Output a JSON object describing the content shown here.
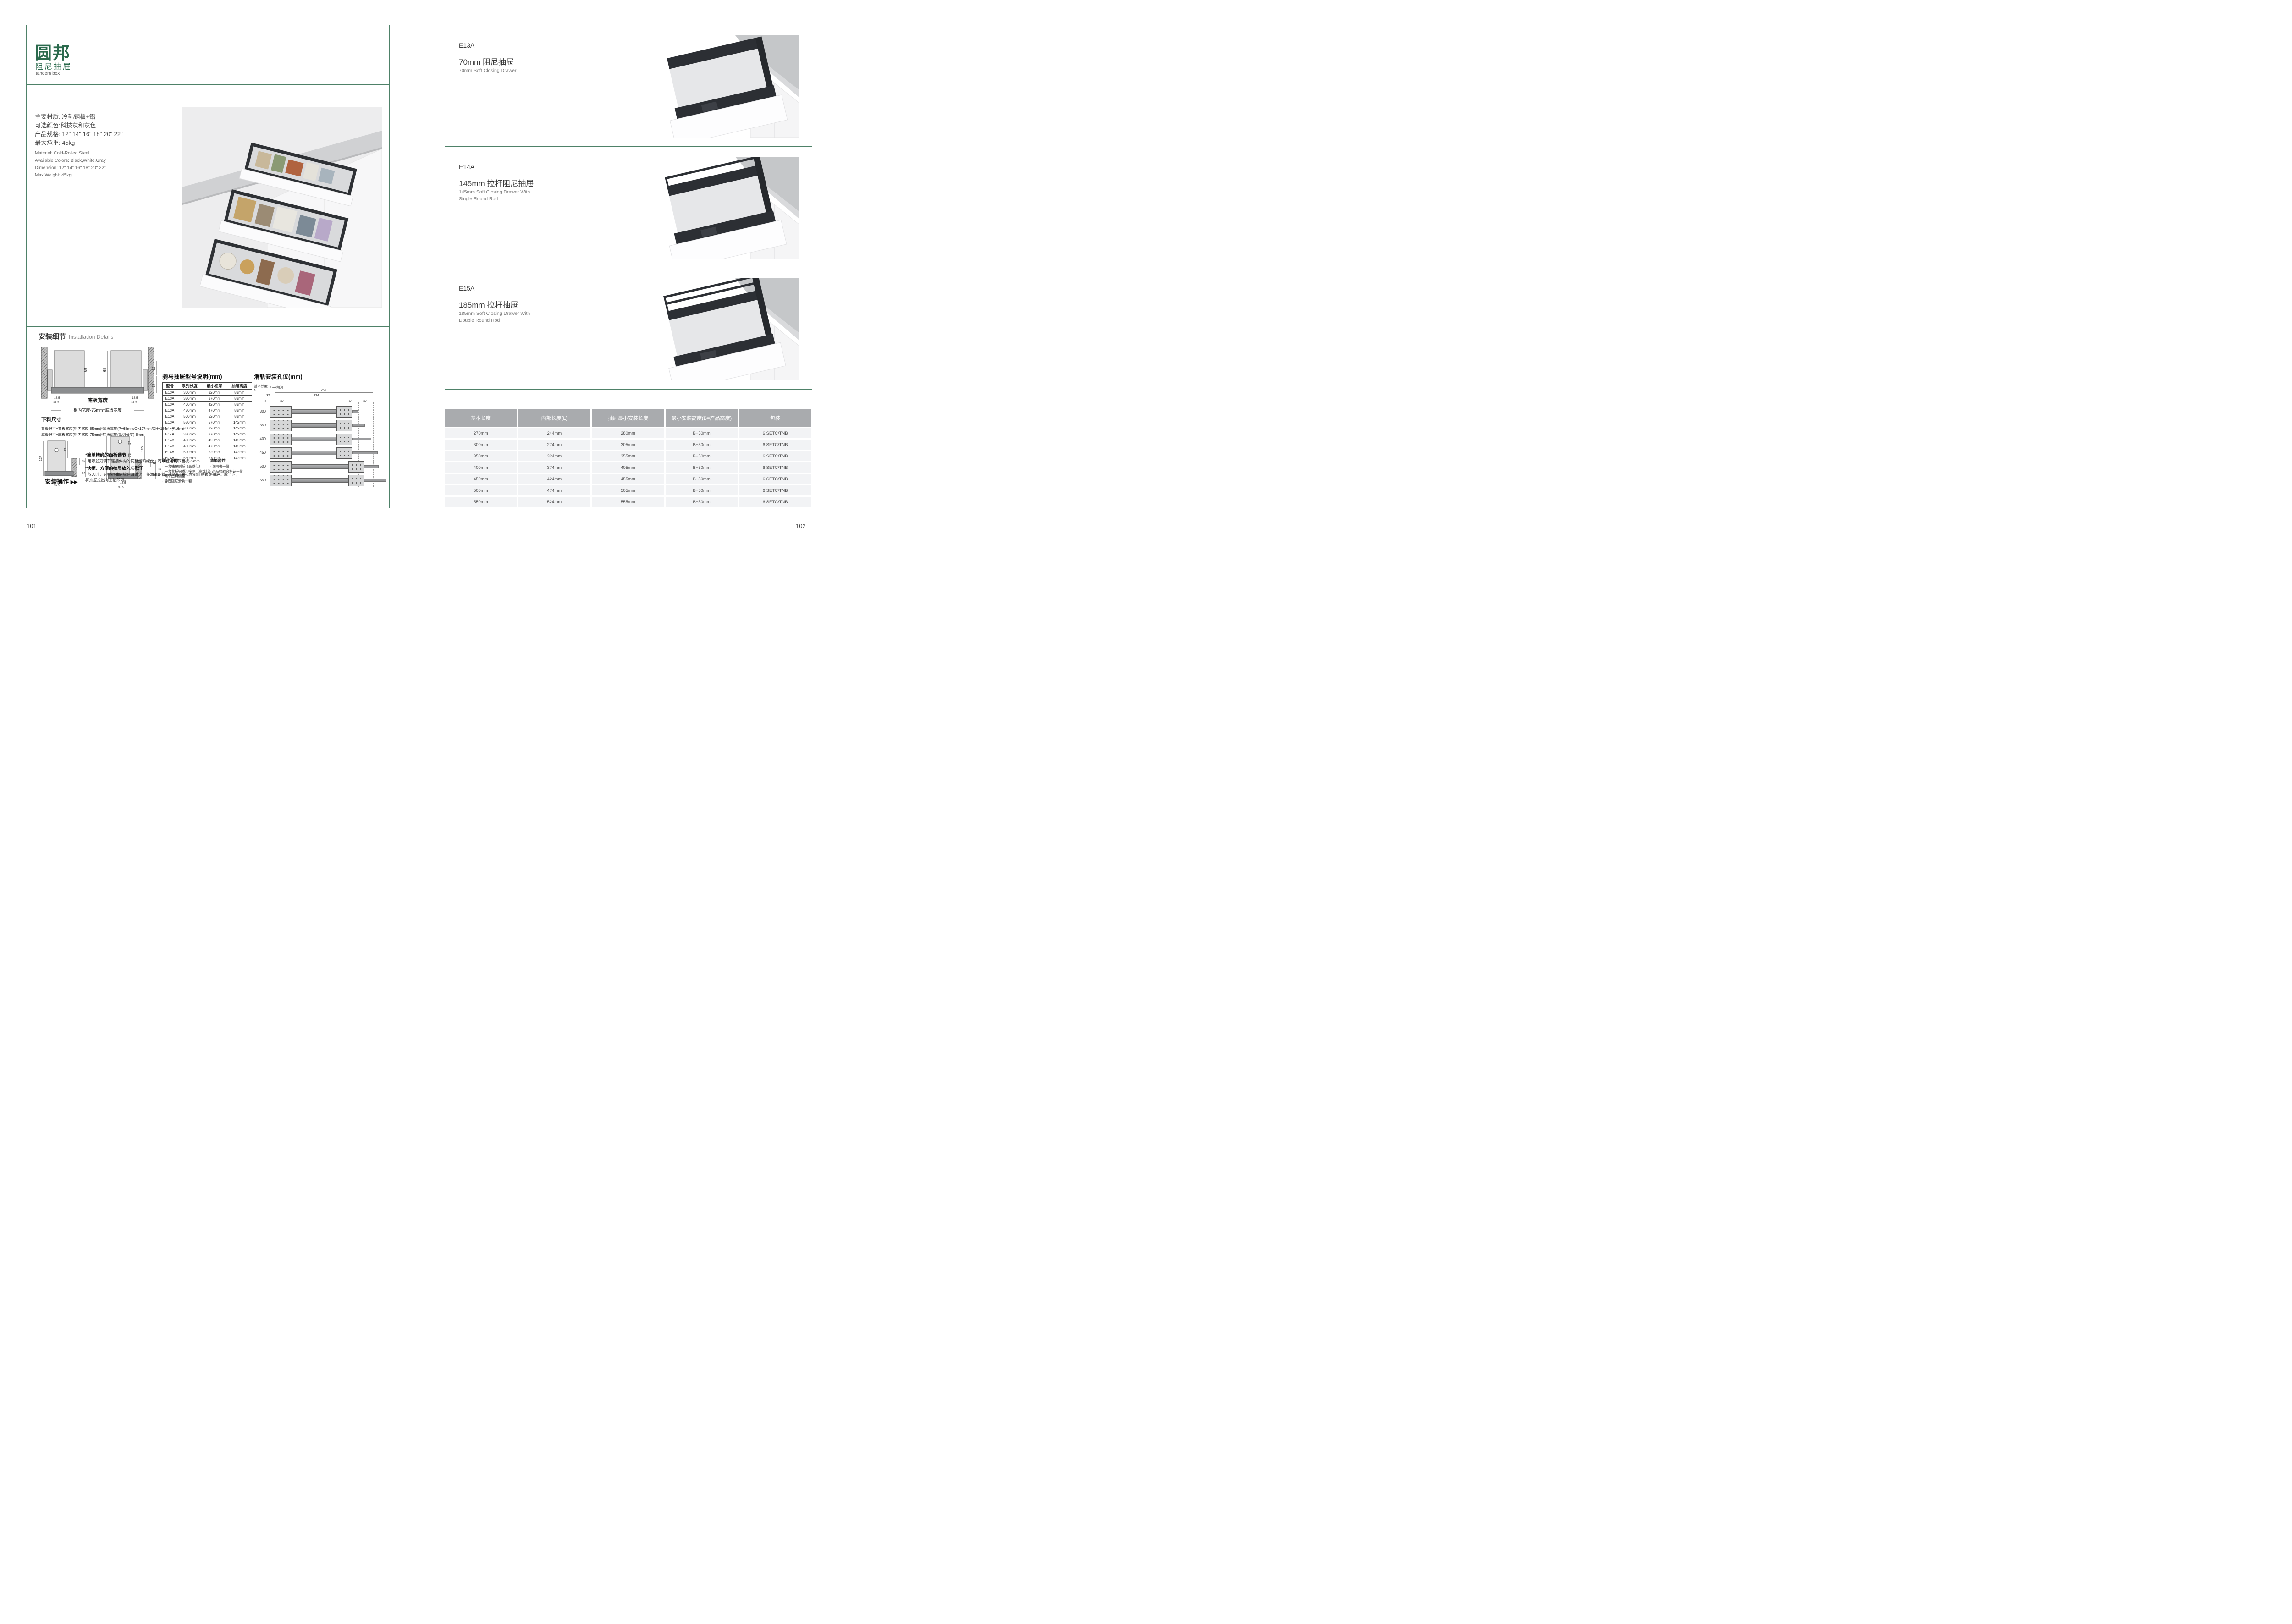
{
  "page_left": {
    "page_number": "101",
    "brand": {
      "logo": "圆邦",
      "subtitle_zh": "阻尼抽屉",
      "subtitle_en": "tandem box"
    },
    "specs_zh": [
      "主要材质: 冷轧钢板+铝",
      "可选颜色:科技灰和灰色",
      "产品规格: 12\" 14\" 16\" 18\" 20\" 22\"",
      "最大承重: 45kg"
    ],
    "specs_en": [
      "Material: Cold-Rolled Steel",
      "Available Colors: Black,White,Gray",
      "Dimension: 12\" 14\" 16\" 18\" 20\" 22\"",
      "Max Weight: 45kg"
    ],
    "install": {
      "title_zh": "安装细节",
      "title_en": "Installation Details",
      "cross_section": {
        "d68a": "68",
        "d68b": "68",
        "d46": "46",
        "d32": "32",
        "d54": "54",
        "d165a": "16.5",
        "d375a": "37.5",
        "d165b": "16.5",
        "d375b": "37.5",
        "bottom_label": "底板宽度",
        "formula_label": "柜内宽度-75mm=底板宽度"
      },
      "cutting": {
        "title": "下料尺寸",
        "line1": "背板尺寸=背板宽度(柜内宽度-85mm)*背板高度(P=68mm/G=127mm/GH=180mm)*16mm",
        "line2": "底板尺寸=底板宽度(柜内宽度-75mm)*底板深度(系列长度)-8mm"
      },
      "side_low": {
        "d127": "127",
        "d77": "77",
        "d32": "32",
        "d86": "86",
        "d54": "54",
        "d165": "16.5",
        "d375": "37.5"
      },
      "side_high": {
        "d180": "180",
        "d57": "57",
        "d73": "73",
        "d130": "130",
        "d32": "32",
        "d86": "86",
        "d54": "54",
        "d165": "16.5",
        "d375": "37.5"
      },
      "operation": {
        "label": "安装操作",
        "arrows": "▶▶",
        "note1_title": "*简单精确的面板调节",
        "note1_body": "· 用螺丝刀调节连接件内的调整塑料螺丝，可以左右调节面板±3mm",
        "note2_title": "*快捷、方便的抽屉放入与取下",
        "note2_body": "· 放入时，只需把抽屉放在滑道上，将滑道的缓冲挡块向后拉就能自动锁定抽屉。取下时，将抽屉拉出向上抬即可。"
      }
    },
    "model_table": {
      "title": "骑马抽屉型号说明(mm)",
      "headers": [
        "型号",
        "系列长度",
        "最小柜深",
        "抽屉高度"
      ],
      "rows": [
        {
          "model": "E13A",
          "length": "300mm",
          "depth": "320mm",
          "height": "83mm"
        },
        {
          "model": "E13A",
          "length": "350mm",
          "depth": "370mm",
          "height": "83mm"
        },
        {
          "model": "E13A",
          "length": "400mm",
          "depth": "420mm",
          "height": "83mm"
        },
        {
          "model": "E13A",
          "length": "450mm",
          "depth": "470mm",
          "height": "83mm"
        },
        {
          "model": "E13A",
          "length": "500mm",
          "depth": "520mm",
          "height": "83mm"
        },
        {
          "model": "E13A",
          "length": "550mm",
          "depth": "570mm",
          "height": "142mm"
        },
        {
          "model": "E14A",
          "length": "300mm",
          "depth": "320mm",
          "height": "142mm"
        },
        {
          "model": "E14A",
          "length": "350mm",
          "depth": "370mm",
          "height": "142mm"
        },
        {
          "model": "E14A",
          "length": "400mm",
          "depth": "420mm",
          "height": "142mm"
        },
        {
          "model": "E14A",
          "length": "450mm",
          "depth": "470mm",
          "height": "142mm"
        },
        {
          "model": "E14A",
          "length": "500mm",
          "depth": "520mm",
          "height": "142mm"
        },
        {
          "model": "E14A",
          "length": "550mm",
          "depth": "570mm",
          "height": "142mm"
        }
      ]
    },
    "components": {
      "title": "组件说明",
      "items": [
        "· 一套抽屉侧板（高或低）",
        "· 一套背板钢质连接件（高或低）",
        "· 两个塑料侧盖",
        "· 静音阻尼滑轨一套"
      ]
    },
    "accessories": {
      "title": "装箱附件",
      "items": [
        "· 说明书一份",
        "· 产品检验合格证一份"
      ]
    },
    "rail_diagram": {
      "title": "滑轨安装孔位(mm)",
      "axis_label": "基本长度",
      "axis_label2": "N L",
      "front_edge_label": "柜子前沿",
      "d37": "37",
      "d9": "9",
      "d32a": "32",
      "d224": "224",
      "d256": "256",
      "d32b": "32",
      "d32c": "32",
      "lengths": [
        "300",
        "350",
        "400",
        "450",
        "500",
        "550"
      ]
    }
  },
  "page_right": {
    "page_number": "102",
    "sections": [
      {
        "model": "E13A",
        "title_zh": "70mm 阻尼抽屉",
        "title_en1": "70mm Soft Closing Drawer",
        "title_en2": ""
      },
      {
        "model": "E14A",
        "title_zh": "145mm 拉杆阻尼抽屉",
        "title_en1": "145mm Soft Closing Drawer With",
        "title_en2": "Single Round Rod"
      },
      {
        "model": "E15A",
        "title_zh": "185mm 拉杆抽屉",
        "title_en1": "185mm Soft Closing Drawer With",
        "title_en2": "Double Round Rod"
      }
    ],
    "spec_table": {
      "headers": [
        "基本长度",
        "内部长度(L)",
        "抽屉最小安装长度",
        "最小安装高度(B=产品高度)",
        "包装"
      ],
      "rows": [
        {
          "c1": "270mm",
          "c2": "244mm",
          "c3": "280mm",
          "c4": "B+50mm",
          "c5": "6 SETC/TNB"
        },
        {
          "c1": "300mm",
          "c2": "274mm",
          "c3": "305mm",
          "c4": "B+50mm",
          "c5": "6 SETC/TNB"
        },
        {
          "c1": "350mm",
          "c2": "324mm",
          "c3": "355mm",
          "c4": "B+50mm",
          "c5": "6 SETC/TNB"
        },
        {
          "c1": "400mm",
          "c2": "374mm",
          "c3": "405mm",
          "c4": "B+50mm",
          "c5": "6 SETC/TNB"
        },
        {
          "c1": "450mm",
          "c2": "424mm",
          "c3": "455mm",
          "c4": "B+50mm",
          "c5": "6 SETC/TNB"
        },
        {
          "c1": "500mm",
          "c2": "474mm",
          "c3": "505mm",
          "c4": "B+50mm",
          "c5": "6 SETC/TNB"
        },
        {
          "c1": "550mm",
          "c2": "524mm",
          "c3": "555mm",
          "c4": "B+50mm",
          "c5": "6 SETC/TNB"
        }
      ]
    }
  }
}
